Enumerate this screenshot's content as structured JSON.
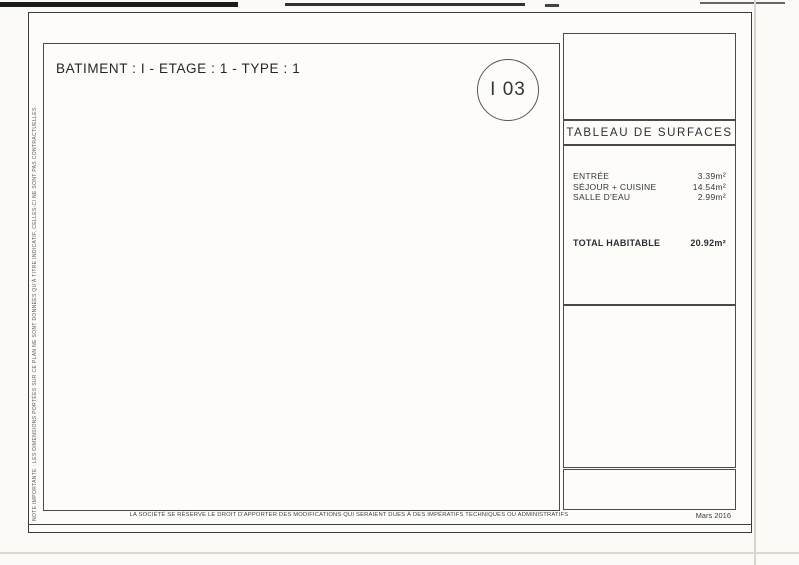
{
  "title": "BATIMENT : I -  ETAGE : 1  -  TYPE : 1",
  "unit_badge": "I 03",
  "compass": {
    "label": "NORD"
  },
  "surface_table": {
    "title": "TABLEAU DE SURFACES",
    "rows": [
      {
        "label": "ENTRÉE",
        "value": "3.39m²"
      },
      {
        "label": "SÉJOUR + CUISINE",
        "value": "14.54m²"
      },
      {
        "label": "SALLE D'EAU",
        "value": "2.99m²"
      }
    ],
    "total": {
      "label": "TOTAL HABITABLE",
      "value": "20.92m²"
    }
  },
  "plan": {
    "room_labels": {
      "sejour": "SÉJOUR",
      "entree": "ENTREE",
      "salle_deau": "SALLE D'EAU",
      "placard": "PL"
    },
    "dimensions": {
      "width": "4,95 m",
      "height": "3.00 m"
    },
    "wall_color": "#1f4e96"
  },
  "scale_bar": {
    "labels": [
      "0m",
      "1m",
      "2m"
    ]
  },
  "site_plan": {
    "compass_label": "NORD"
  },
  "footer": {
    "disclaimer": "LA SOCIÉTÉ SE RÉSERVE LE DROIT D'APPORTER DES MODIFICATIONS QUI SERAIENT DUES À DES IMPÉRATIFS TECHNIQUES OU ADMINISTRATIFS",
    "date": "Mars 2016"
  },
  "side_note": "NOTE IMPORTANTE : LES DIMENSIONS PORTÉES SUR CE PLAN NE SONT DONNÉES QU'À TITRE INDICATIF, CELLES-CI NE SONT PAS CONTRACTUELLES."
}
